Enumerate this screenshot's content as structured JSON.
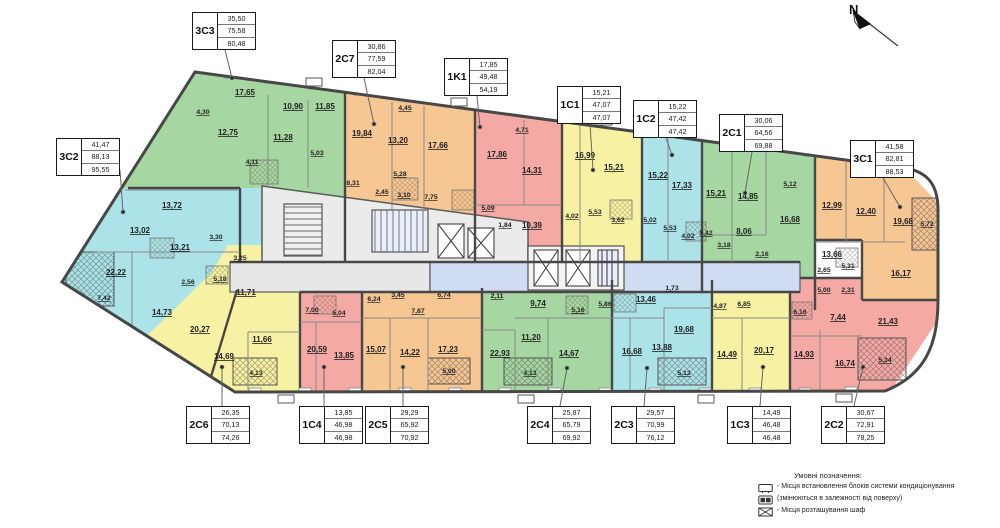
{
  "title": "Floor plan",
  "north_label": "N",
  "apartments": [
    {
      "code": "3C3",
      "areas": [
        "35,50",
        "75,58",
        "80,48"
      ],
      "rooms": [
        "17,65",
        "10,90",
        "11,85",
        "4,30",
        "12,75",
        "11,28",
        "5,03",
        "4,11"
      ]
    },
    {
      "code": "2C7",
      "areas": [
        "30,86",
        "77,59",
        "82,04"
      ],
      "rooms": [
        "19,84",
        "4,45",
        "13,20",
        "17,66",
        "8,31",
        "5,28",
        "2,45",
        "3,10",
        "7,75"
      ]
    },
    {
      "code": "1K1",
      "areas": [
        "17,85",
        "49,48",
        "54,19"
      ],
      "rooms": [
        "17,86",
        "4,71",
        "14,31",
        "5,09",
        "1,84",
        "10,39"
      ]
    },
    {
      "code": "1C1",
      "areas": [
        "15,21",
        "47,07",
        "47,07"
      ],
      "rooms": [
        "16,99",
        "15,21",
        "4,02",
        "5,53",
        "3,62"
      ]
    },
    {
      "code": "1C2",
      "areas": [
        "15,22",
        "47,42",
        "47,42"
      ],
      "rooms": [
        "15,22",
        "17,33",
        "5,02",
        "5,53",
        "4,02"
      ]
    },
    {
      "code": "2C1",
      "areas": [
        "30,06",
        "64,56",
        "69,88"
      ],
      "rooms": [
        "15,21",
        "14,85",
        "5,12",
        "16,68",
        "8,06",
        "5,42",
        "3,18",
        "2,16"
      ]
    },
    {
      "code": "3C1",
      "areas": [
        "41,58",
        "82,81",
        "88,53"
      ],
      "rooms": [
        "12,99",
        "12,40",
        "19,68",
        "5,72",
        "13,66",
        "2,65",
        "5,31",
        "16,17"
      ]
    },
    {
      "code": "3C2",
      "areas": [
        "41,47",
        "88,13",
        "95,55"
      ],
      "rooms": [
        "13,72",
        "13,02",
        "3,30",
        "13,21",
        "22,22",
        "2,56",
        "7,42",
        "14,73"
      ]
    },
    {
      "code": "2C6",
      "areas": [
        "26,35",
        "70,13",
        "74,26"
      ],
      "rooms": [
        "3,25",
        "5,18",
        "11,71",
        "20,27",
        "11,66",
        "14,69",
        "4,13"
      ]
    },
    {
      "code": "1C4",
      "areas": [
        "13,85",
        "46,98",
        "46,98"
      ],
      "rooms": [
        "7,00",
        "5,04",
        "20,59",
        "13,85"
      ]
    },
    {
      "code": "2C5",
      "areas": [
        "29,29",
        "65,92",
        "70,92"
      ],
      "rooms": [
        "6,24",
        "3,45",
        "6,74",
        "7,87",
        "15,07",
        "14,22",
        "17,23",
        "5,00"
      ]
    },
    {
      "code": "2C4",
      "areas": [
        "25,87",
        "65,79",
        "69,92"
      ],
      "rooms": [
        "2,11",
        "9,74",
        "5,16",
        "11,20",
        "22,93",
        "14,67",
        "4,13"
      ]
    },
    {
      "code": "2C3",
      "areas": [
        "29,57",
        "70,99",
        "76,12"
      ],
      "rooms": [
        "1,73",
        "5,86",
        "13,46",
        "19,68",
        "16,68",
        "13,88",
        "5,13"
      ]
    },
    {
      "code": "1C3",
      "areas": [
        "14,49",
        "46,48",
        "46,48"
      ],
      "rooms": [
        "4,87",
        "6,85",
        "14,49",
        "20,17"
      ]
    },
    {
      "code": "2C2",
      "areas": [
        "30,67",
        "72,91",
        "78,25"
      ],
      "rooms": [
        "5,00",
        "2,31",
        "6,16",
        "7,44",
        "21,43",
        "14,93",
        "16,74",
        "5,34"
      ]
    }
  ],
  "colors": {
    "green": "#a6d7a2",
    "orange": "#f6c693",
    "pink": "#f5a9a4",
    "yellow": "#f7f2a3",
    "cyan": "#abe3e9",
    "corridor_blue": "#cfdcf2",
    "core_gray": "#ebebeb",
    "wall": "#474747"
  },
  "legend": {
    "title": "Умовні позначення:",
    "items": [
      {
        "icon": "ac-outdoor-unit-icon",
        "text": "- Місця встановлення блоків системи кондиціонування"
      },
      {
        "icon": "ac-outdoor-unit-filled-icon",
        "text": "(змінюються в залежності від поверху)"
      },
      {
        "icon": "wardrobe-icon",
        "text": "- Місця розташування шаф"
      }
    ]
  }
}
